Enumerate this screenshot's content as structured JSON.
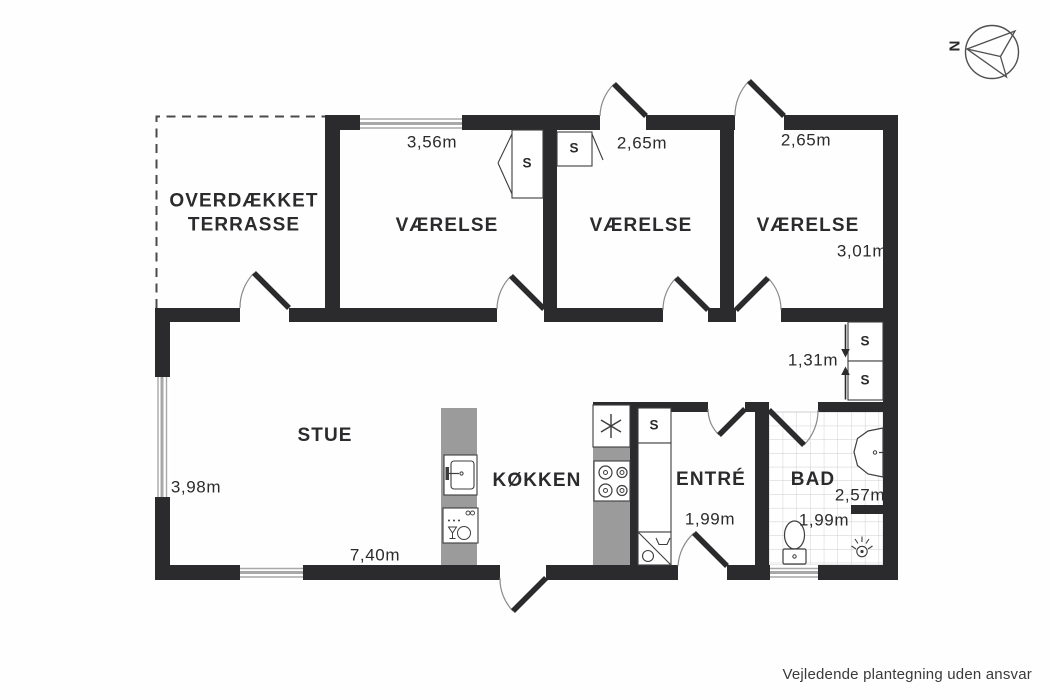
{
  "footer_note": "Vejledende plantegning uden ansvar",
  "compass": {
    "north_label": "N"
  },
  "rooms": {
    "terrace": {
      "name": "OVERDÆKKET\nTERRASSE"
    },
    "bedroom1": {
      "name": "VÆRELSE",
      "width": "3,56m"
    },
    "bedroom2": {
      "name": "VÆRELSE",
      "width": "2,65m"
    },
    "bedroom3": {
      "name": "VÆRELSE",
      "width": "2,65m",
      "depth": "3,01m"
    },
    "hallway": {
      "width": "1,31m"
    },
    "livingroom": {
      "name": "STUE",
      "depth": "3,98m",
      "width": "7,40m"
    },
    "kitchen": {
      "name": "KØKKEN"
    },
    "entrance": {
      "name": "ENTRÉ",
      "width": "1,99m"
    },
    "bathroom": {
      "name": "BAD",
      "depth": "2,57m",
      "width": "1,99m"
    },
    "closet_label": "S"
  },
  "colors": {
    "wall": "#2b2b2d",
    "counter": "#9b9b9b",
    "window": "#a8a8a8",
    "tile_line": "#cccccc",
    "door_arc": "#8a8a8a"
  }
}
